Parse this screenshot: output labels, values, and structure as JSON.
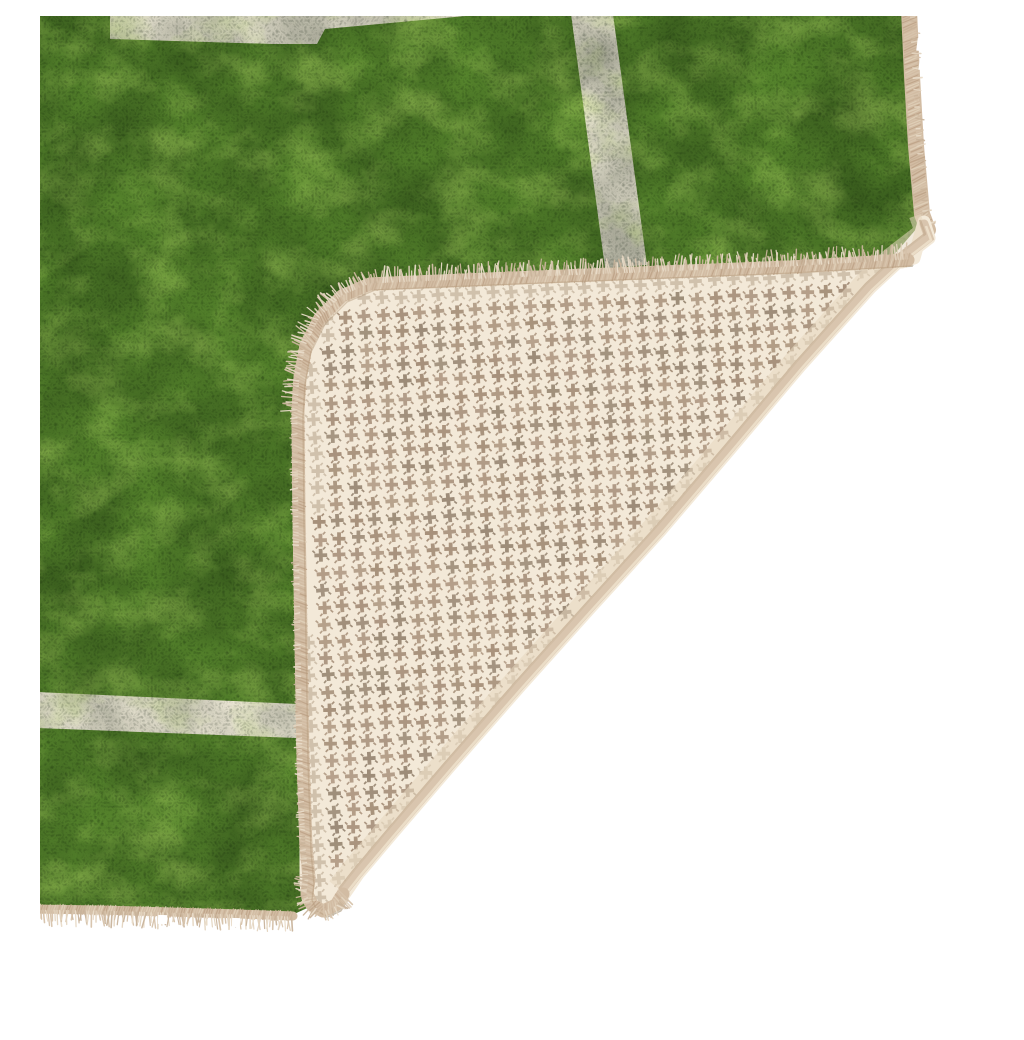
{
  "meta": {
    "description": "Product photo of a green football-pitch style rug with white pitch lines; the bottom-right corner is folded over, revealing a cream anti-slip backing with a taupe houndstooth cross pattern and beige stitched edge binding, on a plain white studio background.",
    "background_color": "#ffffff"
  },
  "rug": {
    "pile_color": "#55832c",
    "line_color": "#ece7d5",
    "binding_color": "#d2bca3",
    "binding_inner_edge": "#b3987a",
    "pile_edge_dark": "#3f6119",
    "fringe_colors": [
      "#e3d4bf",
      "#d6c2aa",
      "#c9b49b",
      "#e9dcc9"
    ],
    "stitch_colors": [
      "#c9b197",
      "#d8c5ae",
      "#bfa489",
      "#e0d0b9"
    ],
    "notch_color": "#ffffff"
  },
  "backing": {
    "base_color": "#f3e9d8",
    "pattern_name": "houndstooth-crosses",
    "cross_colors": [
      "#a6907a",
      "#ab9580",
      "#9c8b77",
      "#b19b85"
    ],
    "cross_faint_color": "#c7b7a1",
    "crease_color": "#d9c5ae",
    "crease_highlight": "#ecdfca",
    "crease_shadow": "#c2aa8e",
    "fold_inner_shade": "#e6d7c0",
    "shadow_color": "rgba(60,70,35,0.22)"
  }
}
